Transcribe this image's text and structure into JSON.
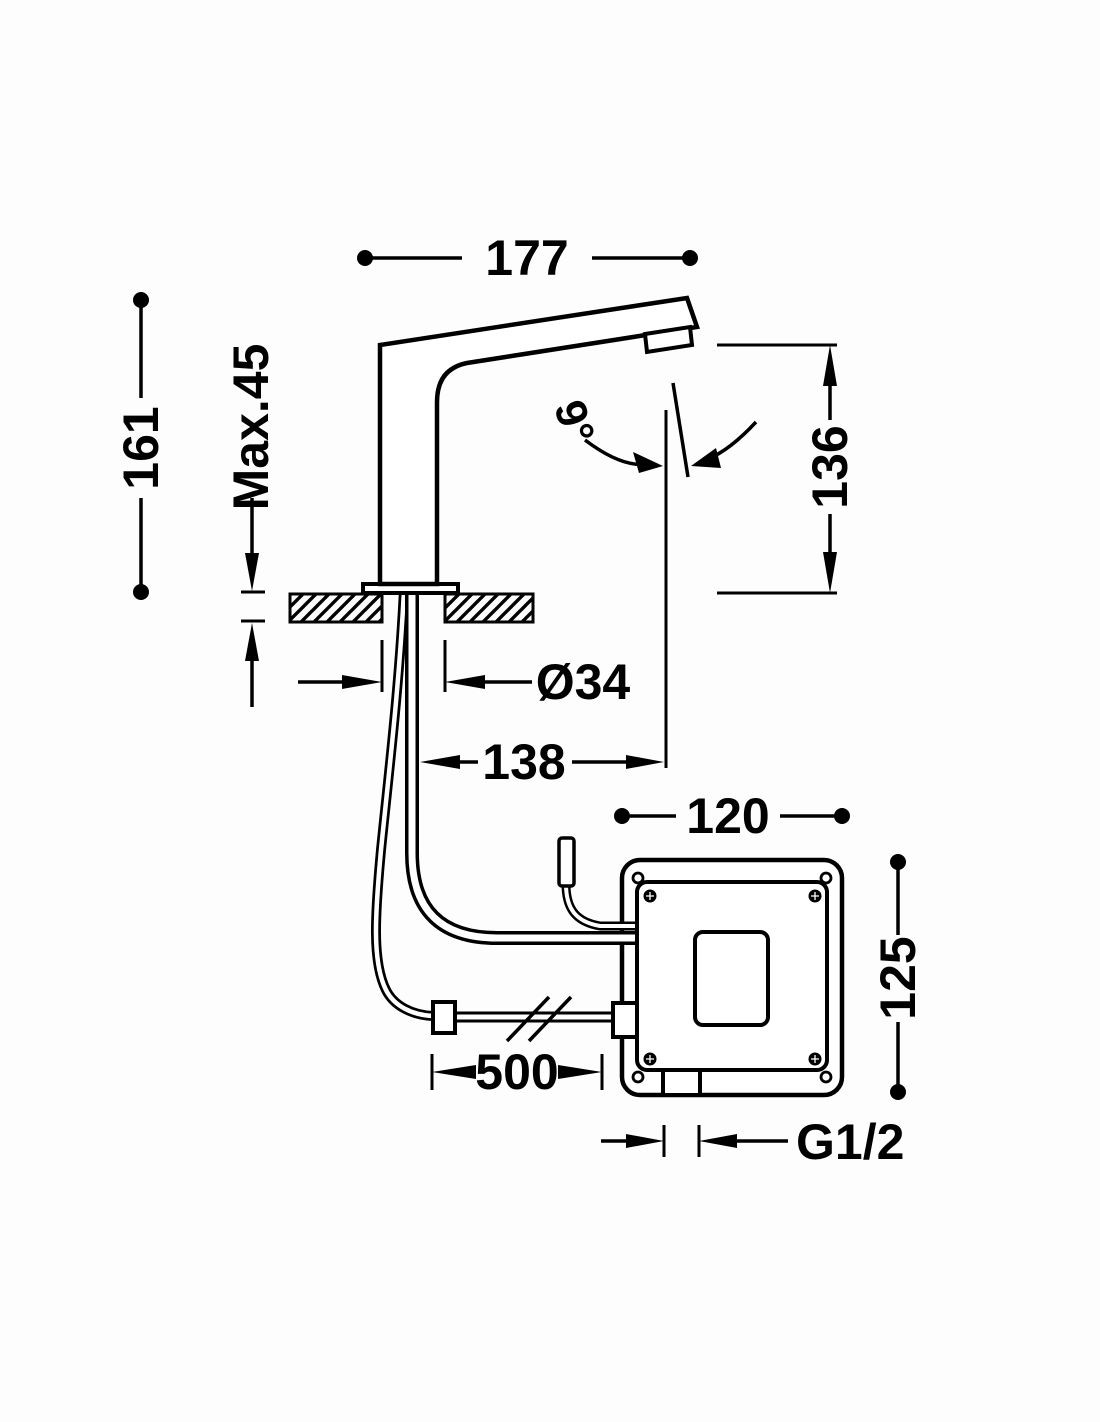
{
  "drawing": {
    "type": "technical-dimension-diagram",
    "subject": "deck-mounted electronic sensor faucet with control box",
    "line_color": "#000000",
    "background_color": "#fdfdfd",
    "dimensions": {
      "spout_reach": "177",
      "overall_height": "161",
      "max_deck_thickness": "Max.45",
      "outlet_height": "136",
      "stream_angle": "9°",
      "hole_diameter": "Ø34",
      "outlet_offset": "138",
      "box_width": "120",
      "box_height": "125",
      "hose_length": "500",
      "thread_size": "G1/2"
    }
  }
}
